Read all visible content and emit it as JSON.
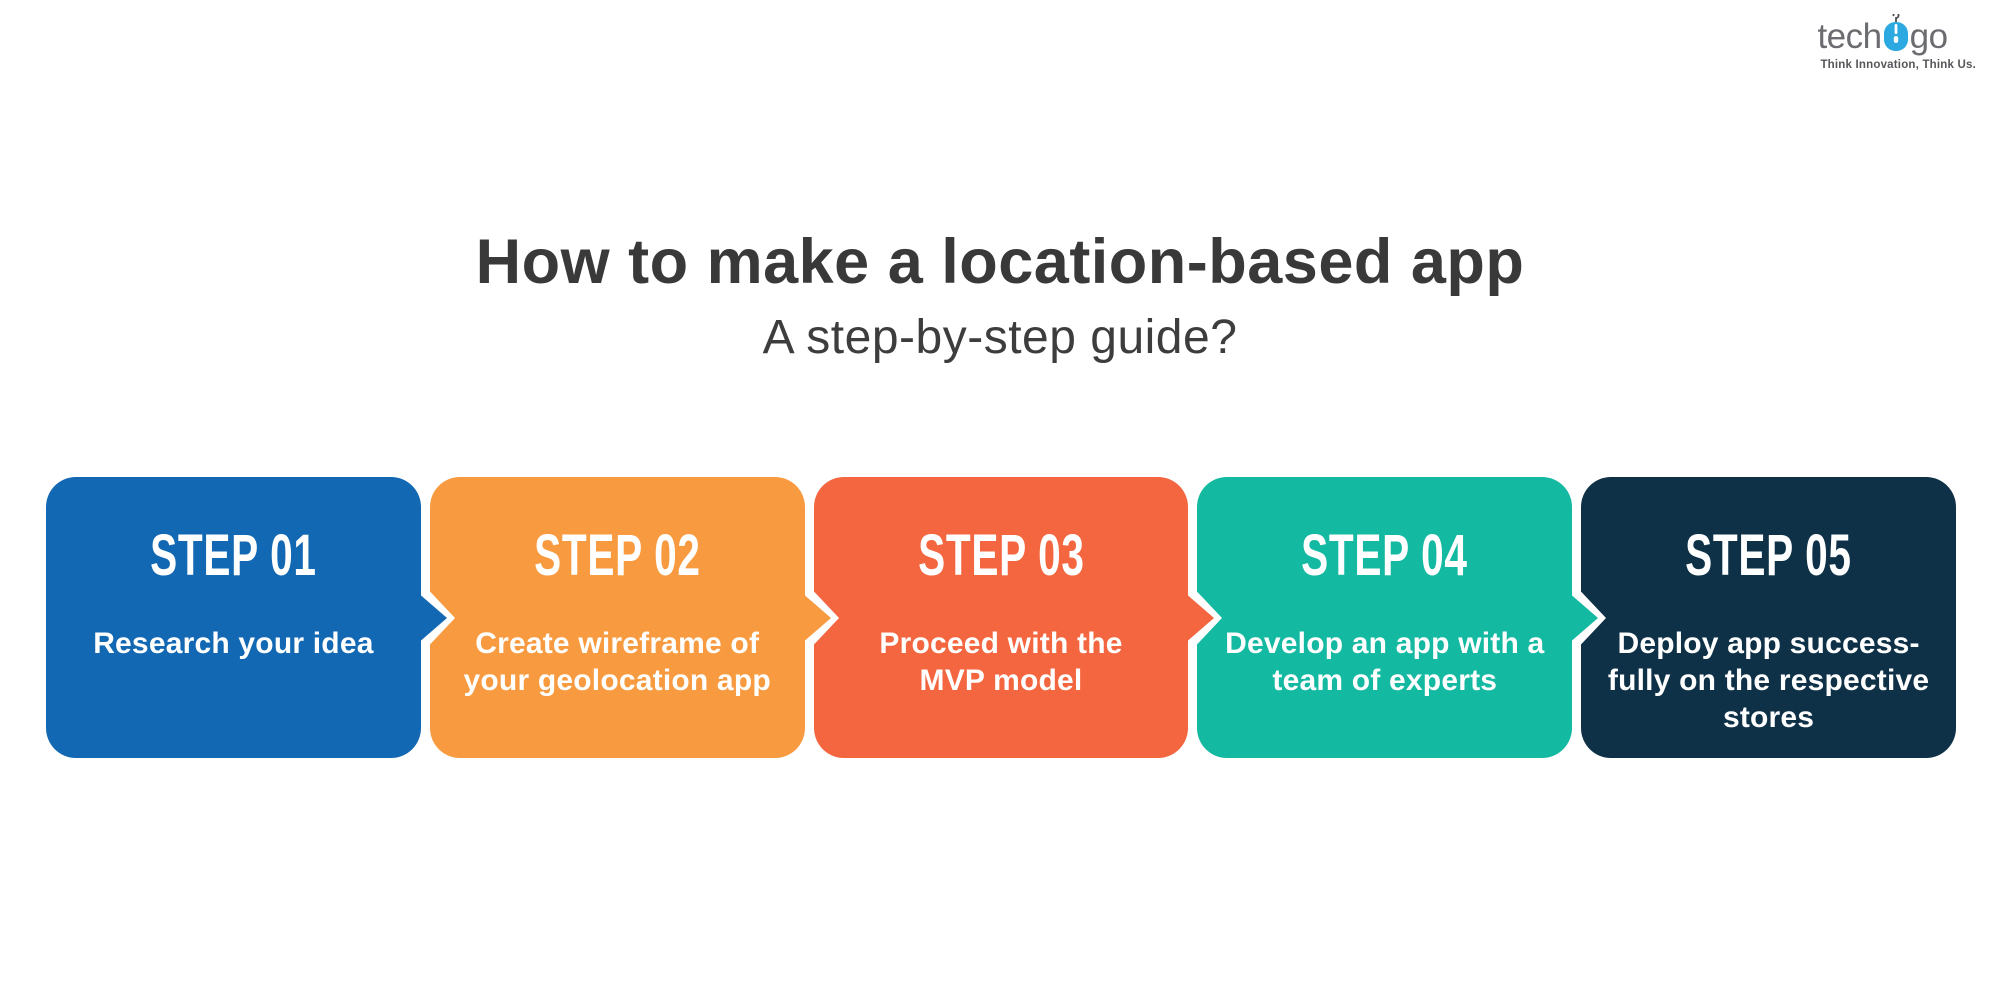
{
  "logo": {
    "brand_prefix": "tech",
    "brand_suffix": "go",
    "mouse_icon_color": "#2BA9E0",
    "text_color": "#6B6C6F",
    "tagline": "Think Innovation, Think Us."
  },
  "title": {
    "line1": "How to make a location-based app",
    "line2": "A step-by-step guide?",
    "color": "#393939"
  },
  "steps": [
    {
      "label": "STEP 01",
      "description": "Research your idea",
      "color": "#1268B3"
    },
    {
      "label": "STEP 02",
      "description": "Create wireframe of\nyour geolocation app",
      "color": "#F89B40"
    },
    {
      "label": "STEP 03",
      "description": "Proceed with the\nMVP model",
      "color": "#F4663F"
    },
    {
      "label": "STEP 04",
      "description": "Develop an app with a\nteam of experts",
      "color": "#14B9A1"
    },
    {
      "label": "STEP 05",
      "description": "Deploy app success-\nfully on the respective\nstores",
      "color": "#0E3147"
    }
  ]
}
